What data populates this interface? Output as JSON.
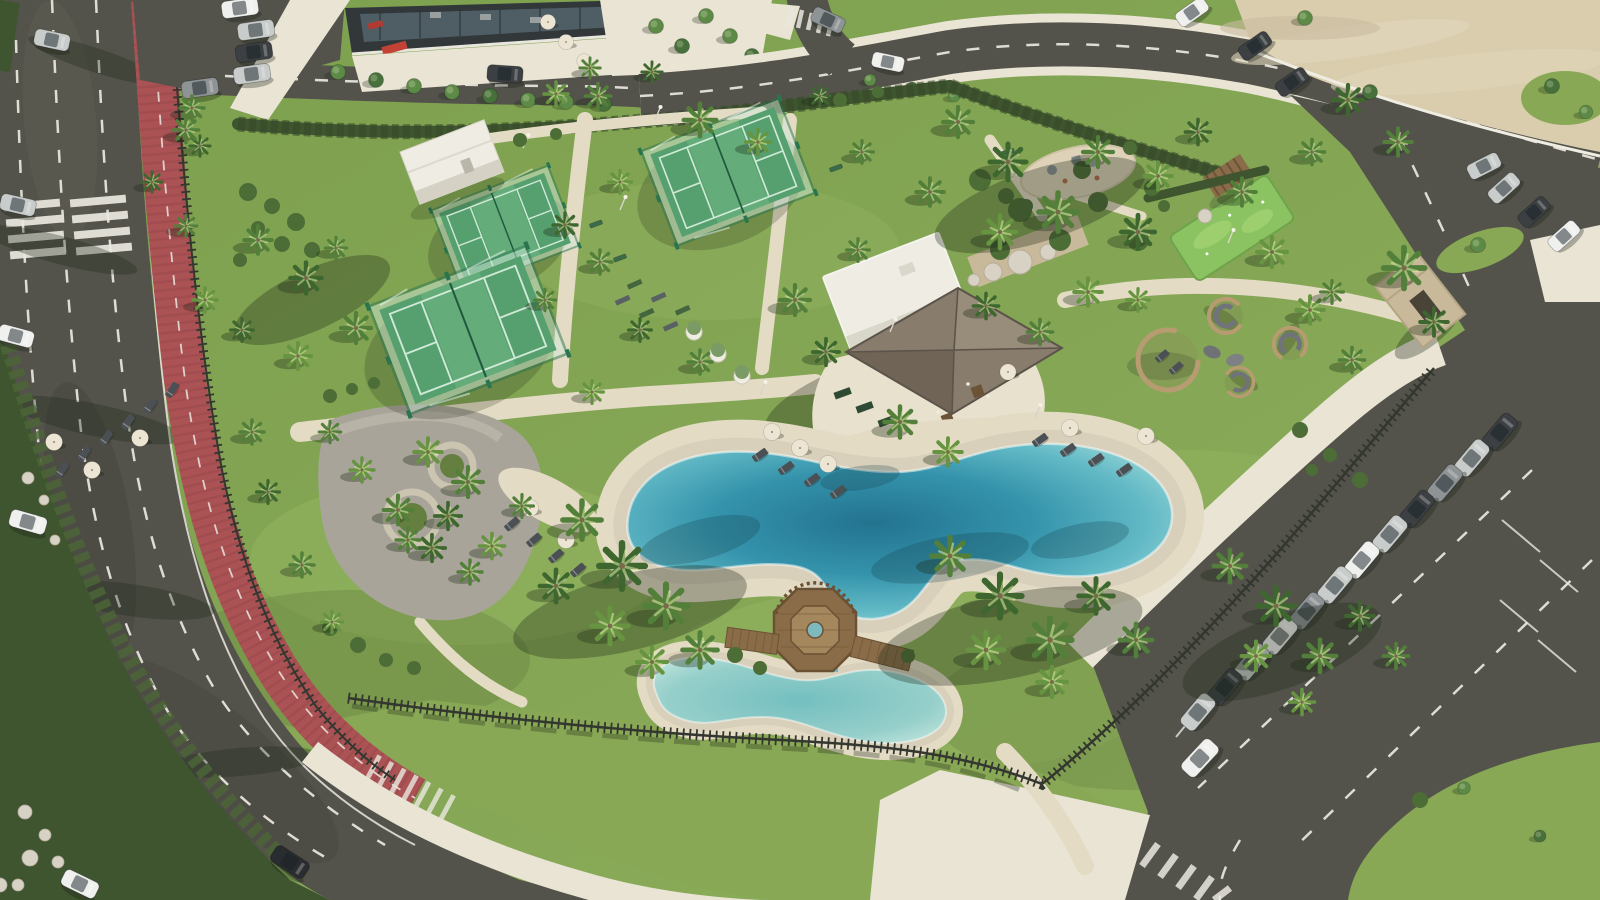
{
  "scene": {
    "title": "Sunny aerial view of a seaside resort amenity park with lagoon pool, padel courts, thatched pool bar, palm gardens, red bike lane and parking lots",
    "weather": "sunny",
    "view": "aerial oblique"
  },
  "palette": {
    "asphalt": "#53534b",
    "asphalt_dark": "#45453f",
    "lane_white": "#eae8df",
    "bike_red": "#ab5255",
    "bike_red_dark": "#8f4548",
    "sidewalk": "#e9e4d4",
    "path": "#e3dbc4",
    "deck": "#e8e1ce",
    "sand": "#d8d0ba",
    "sand_lot": "#d9cdae",
    "lawn": "#7fa04f",
    "lawn_light": "#94b562",
    "lawn_dark": "#647f3f",
    "lawn_outer": "#88a855",
    "hedge": "#3f5530",
    "shrub": "#4d6d37",
    "turf": "#55a06e",
    "turf_light": "#74b886",
    "court_line": "#ddf2e2",
    "court_glass": "#cfe9da",
    "court_frame": "#2a7550",
    "minigolf": "#8cc362",
    "water_deep": "#297e9b",
    "water_mid": "#4aa5b8",
    "water_light": "#82cbd2",
    "water_pale": "#b2dfdc",
    "kids_water": "#96cfca",
    "wood": "#8a6d48",
    "wood_dark": "#6b5134",
    "wood_light": "#a5875e",
    "thatch": "#887c6c",
    "thatch_dark": "#6f6456",
    "thatch_light": "#988c7a",
    "white_bldg": "#eeece3",
    "white_shade": "#d5d2c5",
    "stone": "#c7b999",
    "boulder": "#d8d2c4",
    "fence": "#33372f",
    "palm": "#527f3a",
    "palm_dark": "#3e672f",
    "palm_light": "#669441",
    "trunk": "#8d7c5d",
    "tree": "#5d8a46",
    "tree_dark": "#48703a",
    "umbrella": "#ece5d3",
    "lounger": "#4b5054",
    "gravel": "#a8a499",
    "gravel_light": "#bdb9ad",
    "car_white": "#f0f1ef",
    "car_silver": "#c8cccb",
    "car_gray": "#8e9395",
    "car_dark": "#3c4043",
    "car_black": "#2a2d2f",
    "dark_bldg": "#32373a",
    "glass": "#566870",
    "red_accent": "#b23a31",
    "shadow": "rgba(30,40,24,0.32)",
    "shadow_soft": "rgba(30,40,24,0.2)",
    "water_shadow": "rgba(20,60,72,0.25)"
  },
  "inventory": {
    "padel_courts": 3,
    "pools": 2,
    "pool_types": [
      "lagoon pool",
      "kids pool"
    ],
    "wooden_island_deck": 1,
    "thatched_pavilion": 1,
    "lounge_pods": 4,
    "round_pergola": 1,
    "planter_circles": 2,
    "playground": 1,
    "mini_golf_green": 1,
    "bike_lane_color": "red",
    "highway_lanes": 3,
    "parked_cars_right_row": 12,
    "parked_cars_top_left": 5,
    "sun_loungers": 20,
    "parasols": 14,
    "palm_trees_approx": 90,
    "street_trees_approx": 21,
    "fences": [
      "timber slat fence",
      "hedge boundary"
    ]
  }
}
